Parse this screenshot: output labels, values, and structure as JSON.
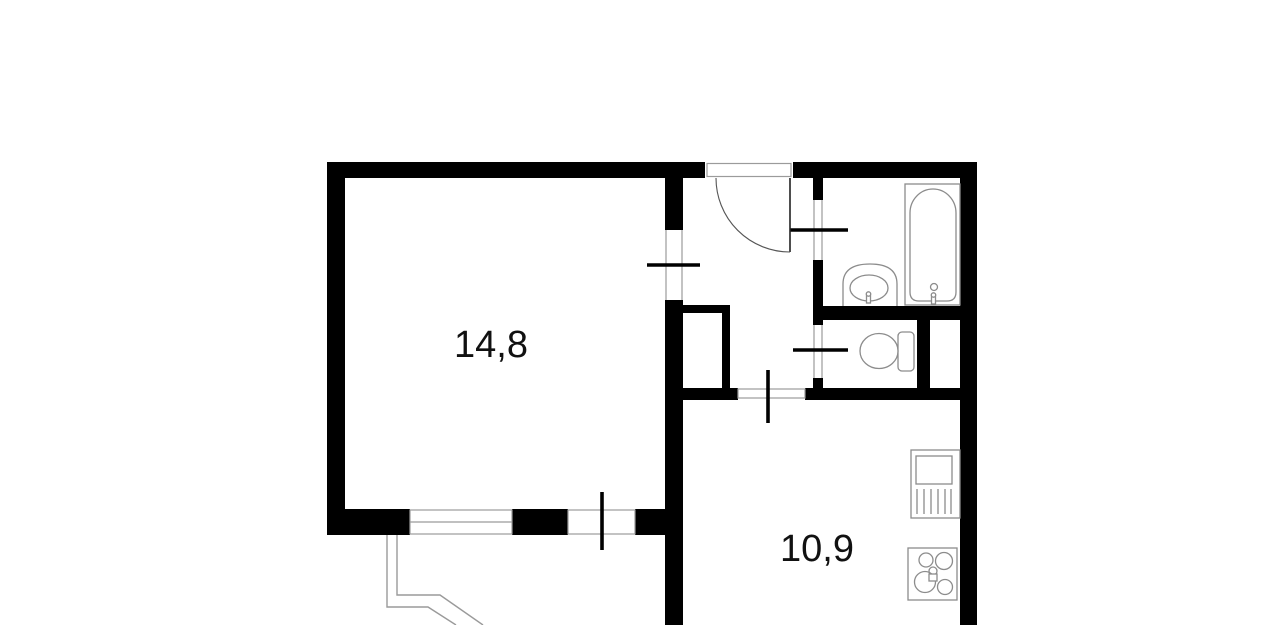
{
  "plan": {
    "type": "apartment-floor-plan",
    "rooms": [
      {
        "id": "living-room",
        "area_label": "14,8"
      },
      {
        "id": "kitchen",
        "area_label": "10,9"
      }
    ],
    "fixtures": [
      "entrance-door",
      "bathtub",
      "wash-basin",
      "toilet",
      "kitchen-sink",
      "stove",
      "window",
      "balcony-door",
      "balcony",
      "closet"
    ],
    "colors": {
      "wall": "#000000",
      "opening_line": "#9b9b9b",
      "fixture_line": "#8c8c8c",
      "text": "#111111",
      "background": "#ffffff"
    }
  }
}
